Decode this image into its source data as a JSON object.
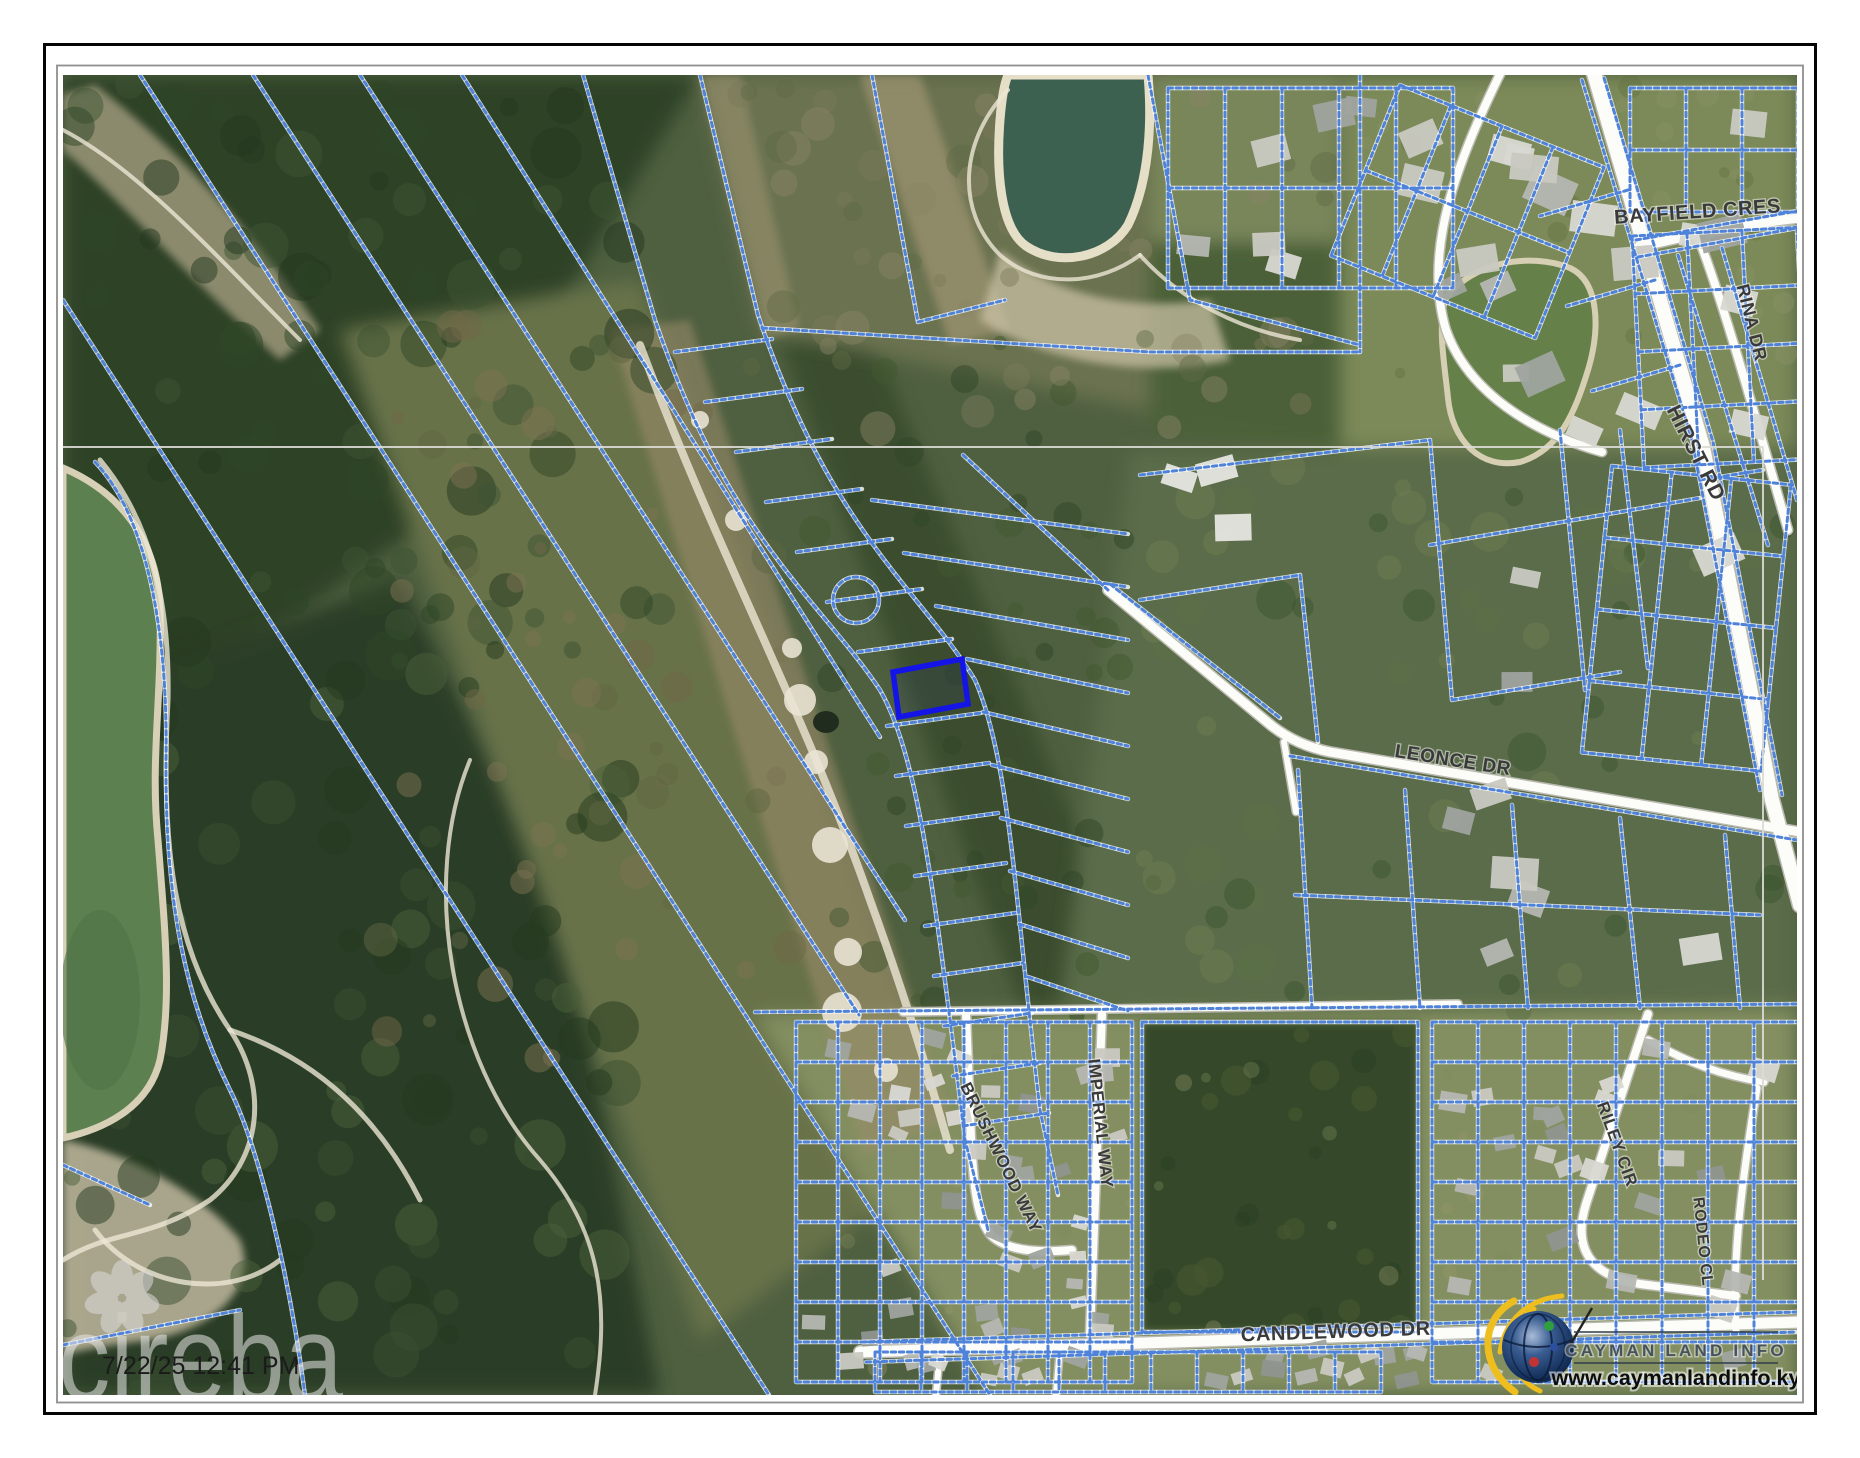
{
  "map": {
    "road_labels": [
      {
        "id": "bayfield-cres",
        "text": "BAYFIELD CRES"
      },
      {
        "id": "rina-dr",
        "text": "RINA DR"
      },
      {
        "id": "hirst-rd",
        "text": "HIRST RD"
      },
      {
        "id": "leonce-dr",
        "text": "LEONCE DR"
      },
      {
        "id": "candlewood-dr",
        "text": "CANDLEWOOD DR"
      },
      {
        "id": "brushwood-way",
        "text": "BRUSHWOOD WAY"
      },
      {
        "id": "imperial-way",
        "text": "IMPERIAL WAY"
      },
      {
        "id": "riley-cir",
        "text": "RILEY CIR"
      },
      {
        "id": "rodeo-cl",
        "text": "RODEO CL"
      }
    ],
    "timestamp": "7/22/25 12:41 PM",
    "watermark": "cireba",
    "colors": {
      "parcel_line": "#4f83da",
      "highlight_parcel": "#1414e6",
      "road": "#fcfcf8"
    }
  },
  "branding": {
    "org": "CAYMAN LAND INFO",
    "website": "www.caymanlandinfo.ky"
  }
}
